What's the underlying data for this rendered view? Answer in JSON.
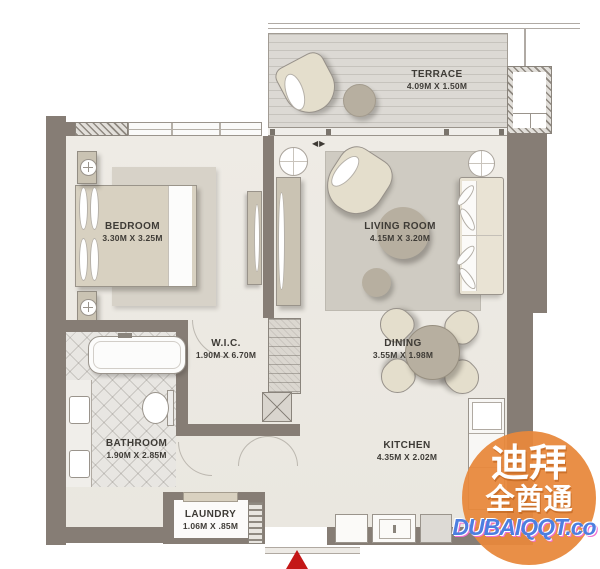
{
  "rooms": {
    "terrace": {
      "label": "TERRACE",
      "dims": "4.09M X 1.50M"
    },
    "bedroom": {
      "label": "BEDROOM",
      "dims": "3.30M X 3.25M"
    },
    "living_room": {
      "label": "LIVING ROOM",
      "dims": "4.15M X 3.20M"
    },
    "wic": {
      "label": "W.I.C.",
      "dims": "1.90M X 6.70M"
    },
    "dining": {
      "label": "DINING",
      "dims": "3.55M X 1.98M"
    },
    "bathroom": {
      "label": "BATHROOM",
      "dims": "1.90M X 2.85M"
    },
    "kitchen": {
      "label": "KITCHEN",
      "dims": "4.35M X 2.02M"
    },
    "laundry": {
      "label": "LAUNDRY",
      "dims": "1.06M X .85M"
    }
  },
  "watermark": {
    "cn_line1": "迪拜",
    "cn_line2": "全酋通",
    "latin": "DUBAIQQT.co",
    "circle_color": "#E8883C",
    "latin_color": "#4D7FE0"
  },
  "markers": {
    "window_arrows": "◀▶",
    "entrance_arrow_color": "#C41717"
  },
  "colors": {
    "wall": "#867D75",
    "floor": "#EDEAE4",
    "deck": "#DCD9D4",
    "furniture_light": "#E4DECC",
    "furniture_mid": "#CAC3B3",
    "furniture_dark": "#B7AFA0",
    "label_text": "#3E3B36"
  }
}
